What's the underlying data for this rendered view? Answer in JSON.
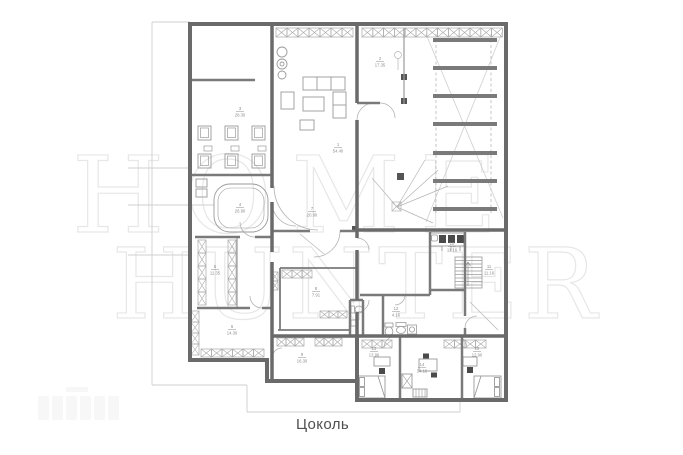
{
  "caption": "Цоколь",
  "watermark": {
    "line1": "HOME",
    "line2": "HUNTER",
    "color": "#e7e7e7"
  },
  "plan": {
    "colors": {
      "wall": "#6a6a6a",
      "interior_wall": "#7a7a7a",
      "thin": "#9a9a9a",
      "furniture": "#9a9a9a",
      "window": "#a8a8a8",
      "light": "#c9c9c9",
      "label": "#8c8c8c",
      "dark_fill": "#4a4a4a",
      "caption": "#4f4f4f"
    },
    "floor_label": "Цоколь",
    "room_labels": [
      {
        "num": "1",
        "area": "54.40",
        "x": 338,
        "y": 146
      },
      {
        "num": "2",
        "area": "17.35",
        "x": 380,
        "y": 60
      },
      {
        "num": "3",
        "area": "28.30",
        "x": 240,
        "y": 110
      },
      {
        "num": "4",
        "area": "26.90",
        "x": 240,
        "y": 206
      },
      {
        "num": "5",
        "area": "11.35",
        "x": 215,
        "y": 268
      },
      {
        "num": "6",
        "area": "14.30",
        "x": 232,
        "y": 328
      },
      {
        "num": "7",
        "area": "20.90",
        "x": 312,
        "y": 210
      },
      {
        "num": "8",
        "area": "7.91",
        "x": 316,
        "y": 290
      },
      {
        "num": "9",
        "area": "16.30",
        "x": 302,
        "y": 356
      },
      {
        "num": "10",
        "area": "11.16",
        "x": 452,
        "y": 245
      },
      {
        "num": "11",
        "area": "11.16",
        "x": 489,
        "y": 268
      },
      {
        "num": "12",
        "area": "4.16",
        "x": 396,
        "y": 310
      },
      {
        "num": "13",
        "area": "12.90",
        "x": 374,
        "y": 350
      },
      {
        "num": "14",
        "area": "14.16",
        "x": 422,
        "y": 366
      },
      {
        "num": "15",
        "area": "12.90",
        "x": 477,
        "y": 350
      }
    ],
    "ramp": {
      "x": 433,
      "width": 64,
      "bar_height": 4,
      "bar_ys": [
        38,
        66,
        94,
        122,
        151,
        179,
        207
      ]
    }
  }
}
